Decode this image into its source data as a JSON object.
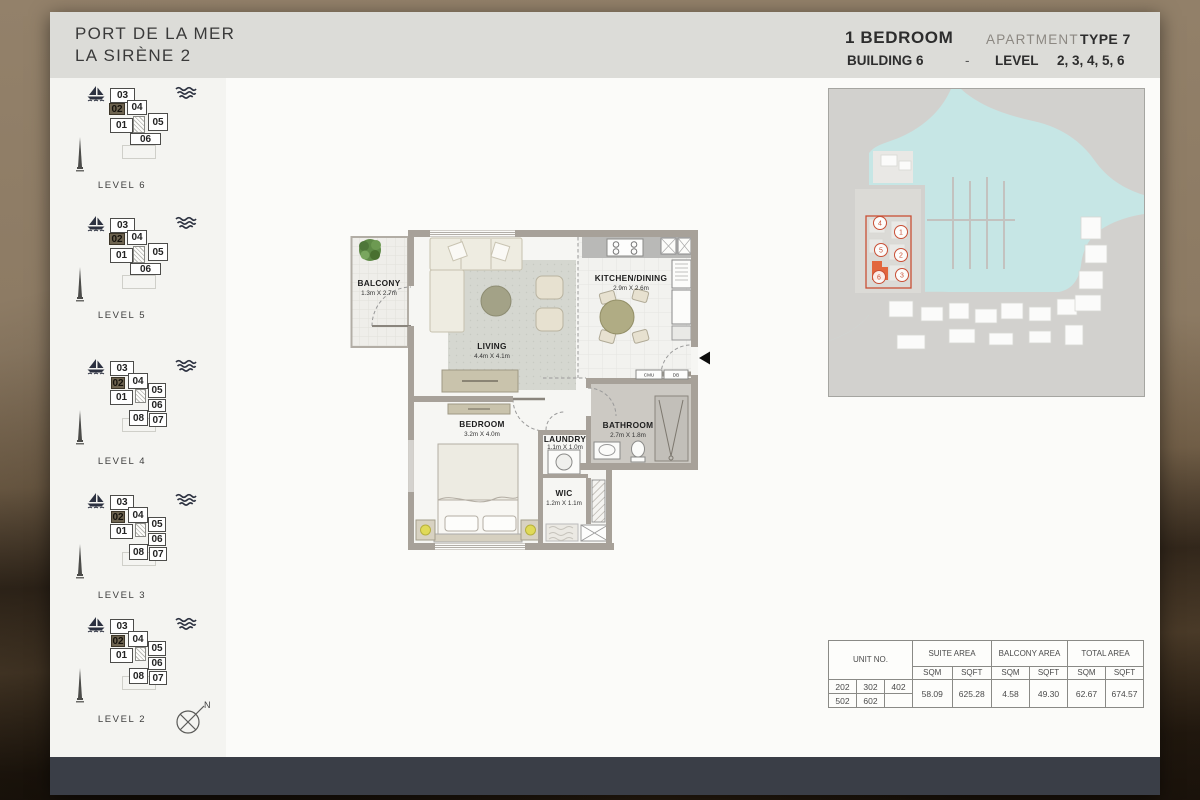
{
  "header": {
    "title_line1": "PORT DE LA MER",
    "title_line2": "LA SIRÈNE 2",
    "unit_type": "1 BEDROOM",
    "apartment_label": "APARTMENT",
    "apartment_type": "TYPE 7",
    "building": "BUILDING 6",
    "separator": "-",
    "level_label": "LEVEL",
    "levels_value": "2, 3, 4, 5, 6"
  },
  "sidebar": {
    "compass_label": "N",
    "levels": [
      {
        "label": "LEVEL 6",
        "layout": "six",
        "units": [
          {
            "no": "03"
          },
          {
            "no": "02",
            "highlight": true
          },
          {
            "no": "01"
          },
          {
            "no": "04"
          },
          {
            "no": "05"
          },
          {
            "no": "06"
          }
        ]
      },
      {
        "label": "LEVEL 5",
        "layout": "six",
        "units": [
          {
            "no": "03"
          },
          {
            "no": "02",
            "highlight": true
          },
          {
            "no": "01"
          },
          {
            "no": "04"
          },
          {
            "no": "05"
          },
          {
            "no": "06"
          }
        ]
      },
      {
        "label": "LEVEL 4",
        "layout": "eight",
        "units": [
          {
            "no": "03"
          },
          {
            "no": "02",
            "highlight": true
          },
          {
            "no": "01"
          },
          {
            "no": "04"
          },
          {
            "no": "05"
          },
          {
            "no": "06"
          },
          {
            "no": "08"
          },
          {
            "no": "07"
          }
        ]
      },
      {
        "label": "LEVEL 3",
        "layout": "eight",
        "units": [
          {
            "no": "03"
          },
          {
            "no": "02",
            "highlight": true
          },
          {
            "no": "01"
          },
          {
            "no": "04"
          },
          {
            "no": "05"
          },
          {
            "no": "06"
          },
          {
            "no": "08"
          },
          {
            "no": "07"
          }
        ]
      },
      {
        "label": "LEVEL 2",
        "layout": "eight",
        "units": [
          {
            "no": "03"
          },
          {
            "no": "02",
            "highlight": true
          },
          {
            "no": "01"
          },
          {
            "no": "04"
          },
          {
            "no": "05"
          },
          {
            "no": "06"
          },
          {
            "no": "08"
          },
          {
            "no": "07"
          }
        ]
      }
    ]
  },
  "floorplan": {
    "rooms": {
      "balcony": {
        "name": "BALCONY",
        "dims": "1.3m X 2.7m"
      },
      "living": {
        "name": "LIVING",
        "dims": "4.4m X 4.1m"
      },
      "kitchen": {
        "name": "KITCHEN/DINING",
        "dims": "2.9m X 2.6m"
      },
      "bedroom": {
        "name": "BEDROOM",
        "dims": "3.2m X 4.0m"
      },
      "laundry": {
        "name": "LAUNDRY",
        "dims": "1.1m X 1.0m"
      },
      "bathroom": {
        "name": "BATHROOM",
        "dims": "2.7m X 1.8m"
      },
      "wic": {
        "name": "WIC",
        "dims": "1.2m X 1.1m"
      }
    },
    "panels": [
      "CMU",
      "DB"
    ]
  },
  "site_map": {
    "markers": [
      {
        "no": "1"
      },
      {
        "no": "2"
      },
      {
        "no": "3"
      },
      {
        "no": "4"
      },
      {
        "no": "5"
      },
      {
        "no": "6",
        "highlight": true
      }
    ]
  },
  "area_table": {
    "headers": {
      "unit": "UNIT NO.",
      "suite": "SUITE AREA",
      "balcony": "BALCONY AREA",
      "total": "TOTAL AREA",
      "sqm": "SQM",
      "sqft": "SQFT"
    },
    "unit_rows": [
      [
        "202",
        "302",
        "402"
      ],
      [
        "502",
        "602",
        ""
      ]
    ],
    "values": {
      "suite_sqm": "58.09",
      "suite_sqft": "625.28",
      "balcony_sqm": "4.58",
      "balcony_sqft": "49.30",
      "total_sqm": "62.67",
      "total_sqft": "674.57"
    }
  },
  "icons": {
    "boat": "boat-icon",
    "waves": "waves-icon",
    "spire": "spire-icon",
    "compass": "compass-icon",
    "entry_arrow": "entry-arrow-icon",
    "plant": "plant-icon"
  },
  "colors": {
    "header_band": "#dcdcd8",
    "footer_bar": "#3a3e47",
    "map_water": "#c6e6e5",
    "map_land": "#d2d1ce",
    "highlight_red": "#c94f35",
    "building_highlight": "#e2663d",
    "unit_highlight_bg": "#6e6450",
    "wall": "#a7a199"
  }
}
